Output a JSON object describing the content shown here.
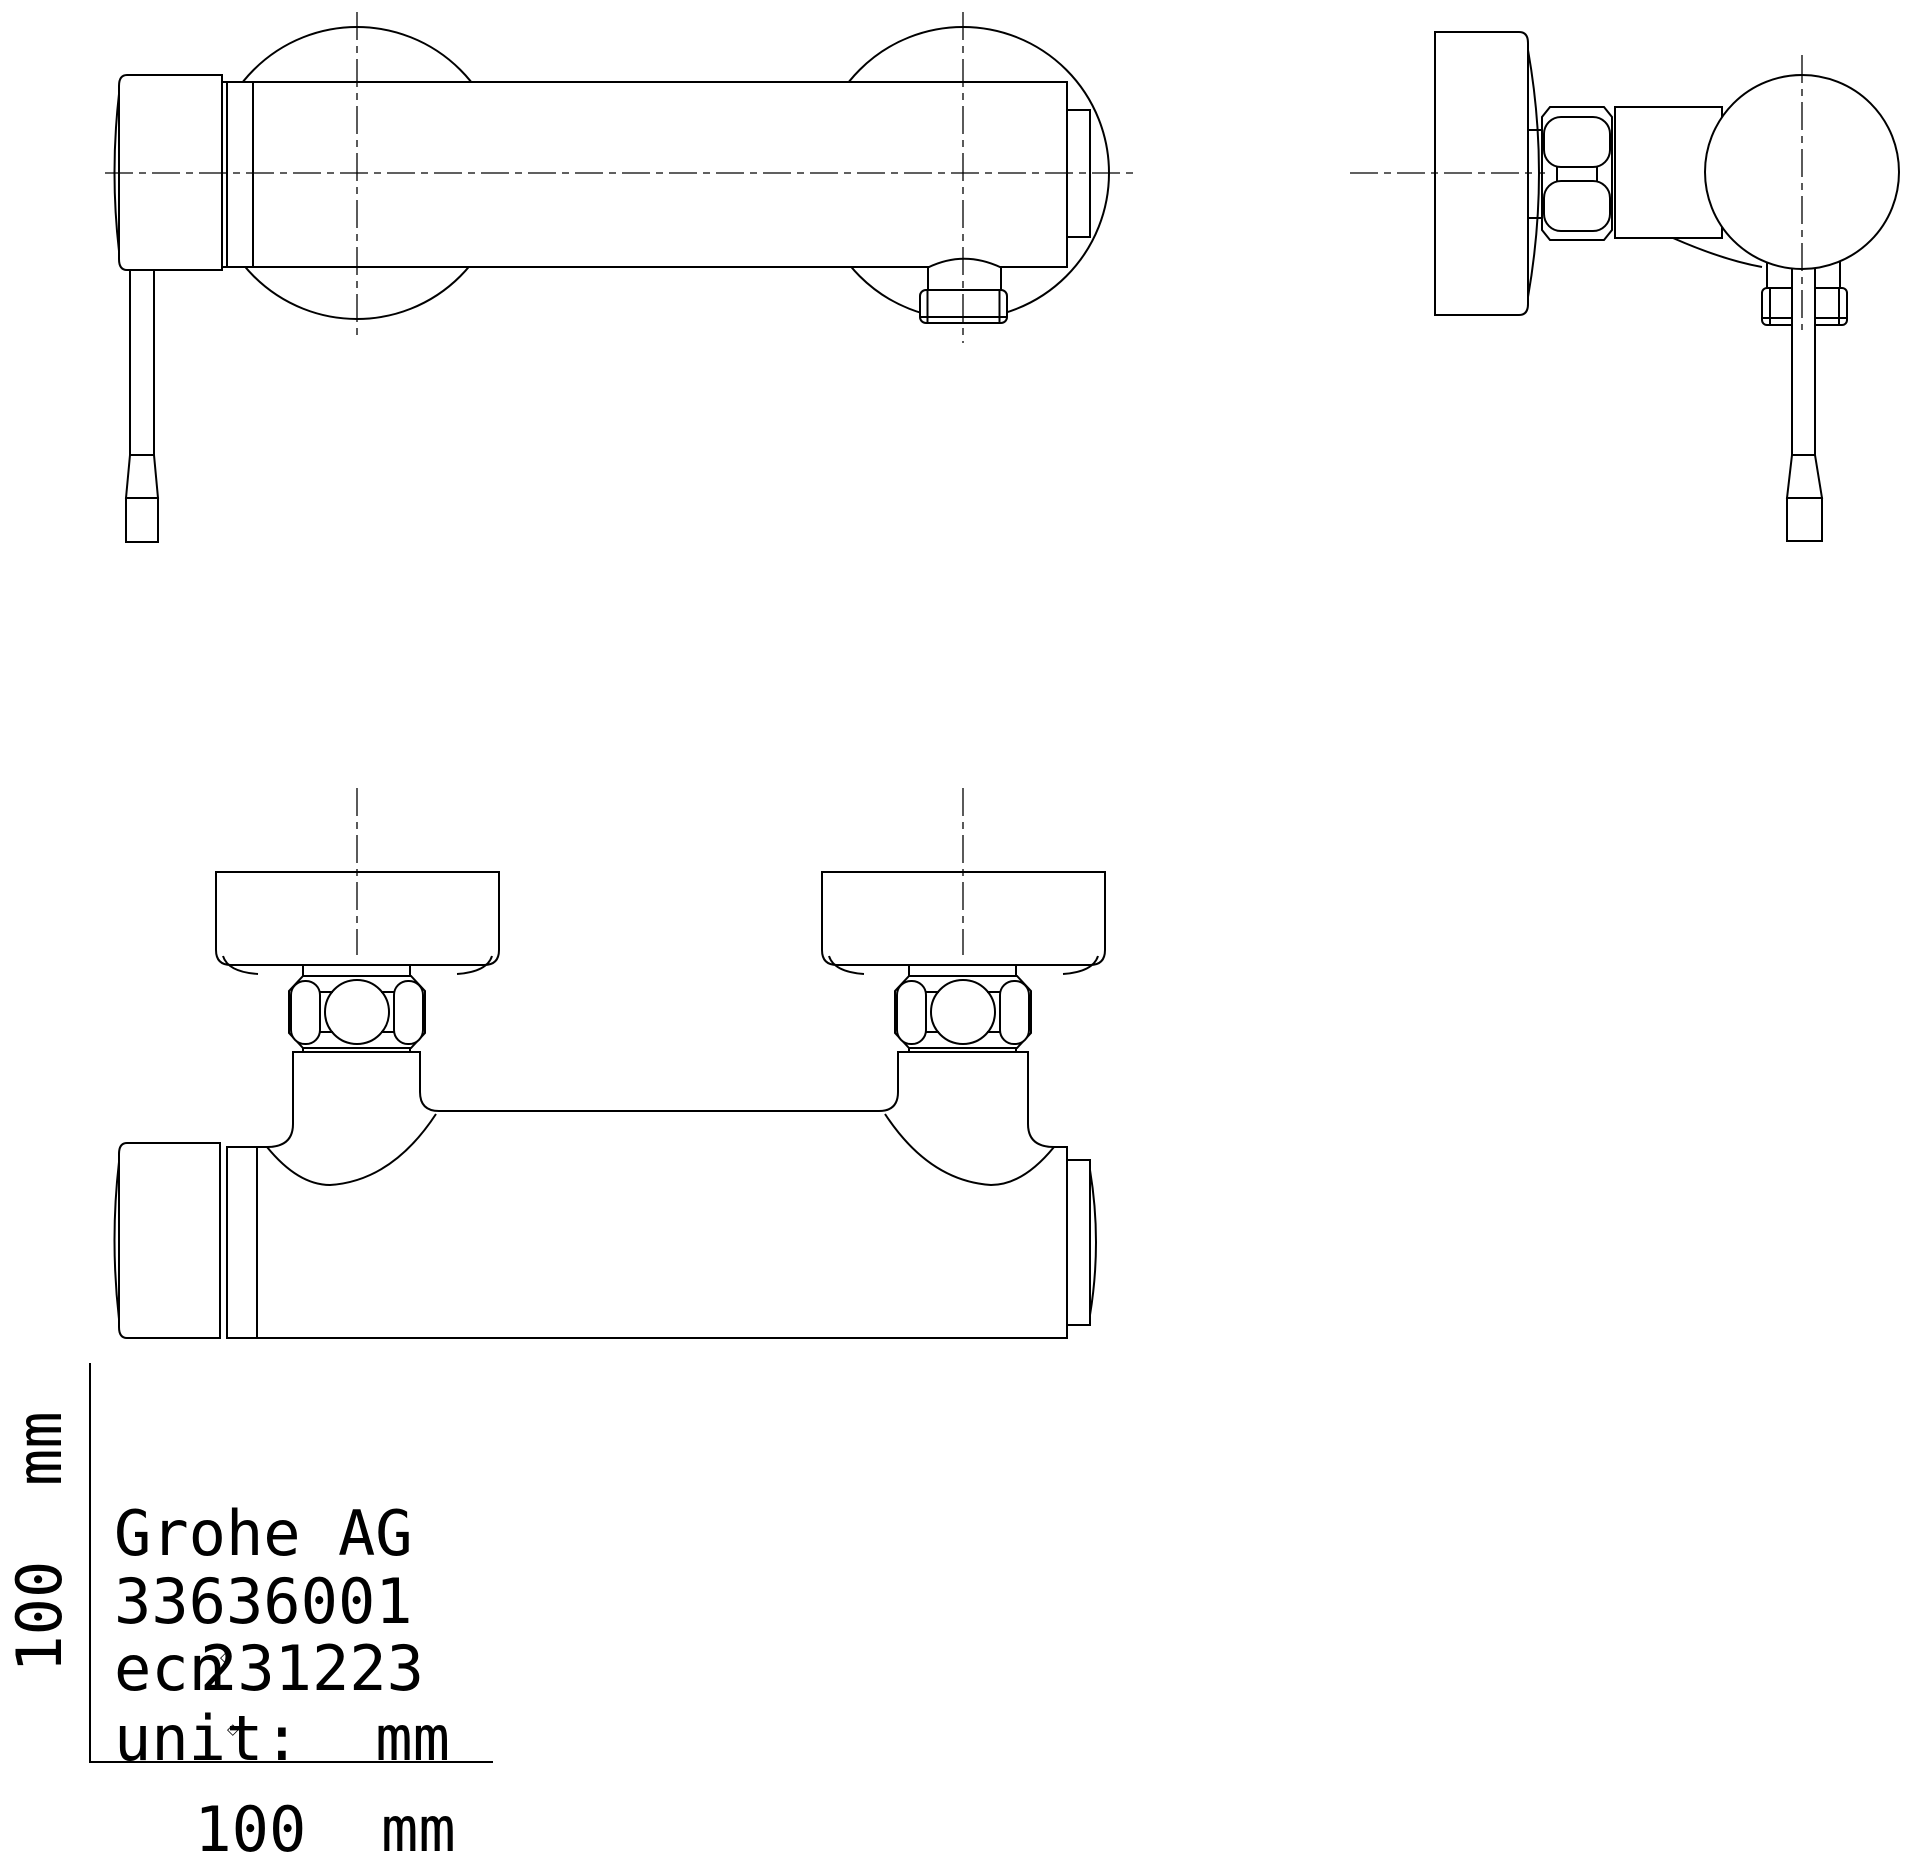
{
  "drawing": {
    "texts": {
      "manufacturer": "Grohe AG",
      "product_code": "33636001",
      "ecn_prefix": "ecn",
      "ecn_number": "231223",
      "unit": "unit:  mm",
      "scale_h": "100  mm",
      "scale_v": "100  mm",
      "stray_marker": "◇"
    },
    "colors": {
      "line": "#000000",
      "background": "#ffffff"
    },
    "views": {
      "front_view": "shower mixer front elevation",
      "side_view": "shower mixer side elevation",
      "bottom_view": "shower mixer plan view",
      "scale": "100 mm reference ruler"
    }
  }
}
